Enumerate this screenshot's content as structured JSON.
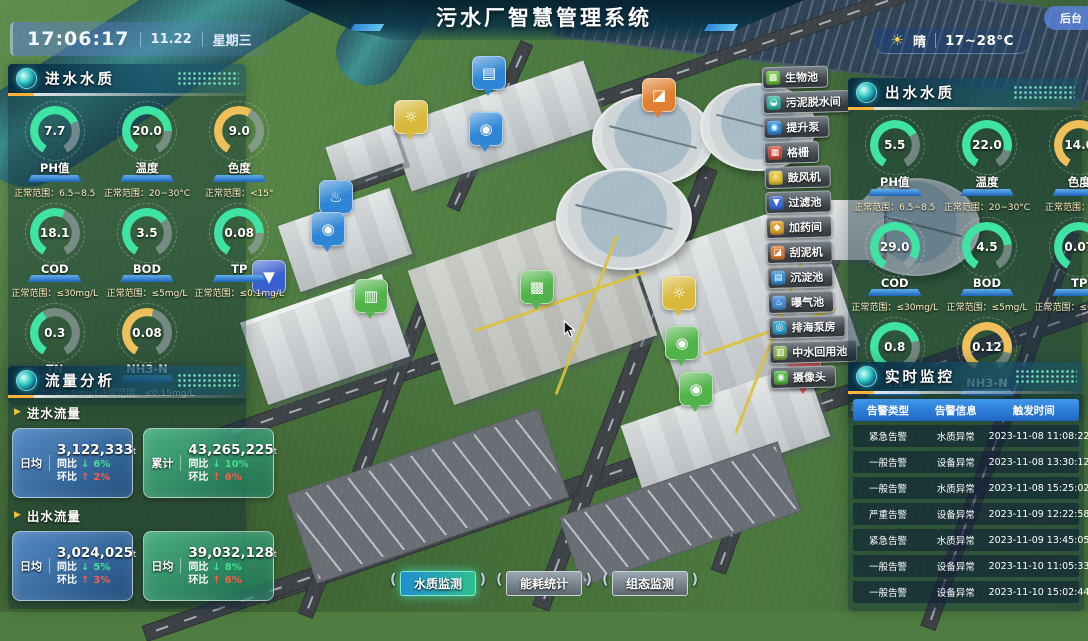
{
  "header": {
    "title": "污水厂智慧管理系统",
    "time": "17:06:17",
    "date": "11.22",
    "weekday": "星期三",
    "weather_icon": "☀",
    "weather": "晴",
    "temp_range": "17~28°C",
    "backend_label": "后台"
  },
  "labels": {
    "range_prefix": "正常范围：",
    "yoy": "同比",
    "mom": "环比",
    "down_arrow": "↓",
    "up_arrow": "↑"
  },
  "colors": {
    "gauge_green": "#3fe3a4",
    "gauge_yellow": "#eec05a",
    "label_bar_blue": "#2e7cd6",
    "trend_down_green": "#3fe38f",
    "trend_up_red": "#ff5a4a"
  },
  "inlet_quality": {
    "title": "进水水质",
    "gauges": [
      {
        "label": "PH值",
        "value": "7.7",
        "range": "6.5~8.5",
        "color": "#3fe3a4",
        "percent": 72
      },
      {
        "label": "温度",
        "value": "20.0",
        "range": "20~30°C",
        "color": "#3fe3a4",
        "percent": 80
      },
      {
        "label": "色度",
        "value": "9.0",
        "range": "<15°",
        "color": "#eec05a",
        "percent": 60
      },
      {
        "label": "COD",
        "value": "18.1",
        "range": "≤30mg/L",
        "color": "#3fe3a4",
        "percent": 58
      },
      {
        "label": "BOD",
        "value": "3.5",
        "range": "≤5mg/L",
        "color": "#3fe3a4",
        "percent": 68
      },
      {
        "label": "TP",
        "value": "0.08",
        "range": "≤0.1mg/L",
        "color": "#3fe3a4",
        "percent": 80
      },
      {
        "label": "TN",
        "value": "0.3",
        "range": "≤1.0mg/L",
        "color": "#3fe3a4",
        "percent": 40
      },
      {
        "label": "NH3-N",
        "value": "0.08",
        "range": "≤0.15mg/L",
        "color": "#eec05a",
        "percent": 55
      }
    ]
  },
  "outlet_quality": {
    "title": "出水水质",
    "gauges": [
      {
        "label": "PH值",
        "value": "5.5",
        "range": "6.5~8.5",
        "color": "#3fe3a4",
        "percent": 70
      },
      {
        "label": "温度",
        "value": "22.0",
        "range": "20~30°C",
        "color": "#3fe3a4",
        "percent": 85
      },
      {
        "label": "色度",
        "value": "14.0",
        "range": "<15°",
        "color": "#eec05a",
        "percent": 88
      },
      {
        "label": "COD",
        "value": "29.0",
        "range": "≤30mg/L",
        "color": "#3fe3a4",
        "percent": 90
      },
      {
        "label": "BOD",
        "value": "4.5",
        "range": "≤5mg/L",
        "color": "#3fe3a4",
        "percent": 78
      },
      {
        "label": "TP",
        "value": "0.07",
        "range": "≤0.1mg/L",
        "color": "#3fe3a4",
        "percent": 70
      },
      {
        "label": "TN",
        "value": "0.8",
        "range": "≤1.0mg/L",
        "color": "#3fe3a4",
        "percent": 75
      },
      {
        "label": "NH3-N",
        "value": "0.12",
        "range": "≤0.15mg/L",
        "color": "#eec05a",
        "percent": 85
      }
    ]
  },
  "flow": {
    "title": "流量分析",
    "inlet": {
      "subtitle": "进水流量",
      "cards": [
        {
          "tag": "日均",
          "value": "3,122,333",
          "unit": "t",
          "yoy": "6%",
          "mom": "2%",
          "style": "blue"
        },
        {
          "tag": "累计",
          "value": "43,265,225",
          "unit": "t",
          "yoy": "10%",
          "mom": "6%",
          "style": "green"
        }
      ]
    },
    "outlet": {
      "subtitle": "出水流量",
      "cards": [
        {
          "tag": "日均",
          "value": "3,024,025",
          "unit": "t",
          "yoy": "5%",
          "mom": "3%",
          "style": "blue"
        },
        {
          "tag": "日均",
          "value": "39,032,128",
          "unit": "t",
          "yoy": "8%",
          "mom": "6%",
          "style": "green"
        }
      ]
    }
  },
  "monitor": {
    "title": "实时监控",
    "columns": [
      "告警类型",
      "告警信息",
      "触发时间"
    ],
    "rows": [
      [
        "紧急告警",
        "水质异常",
        "2023-11-08 11:08:22"
      ],
      [
        "一般告警",
        "设备异常",
        "2023-11-08 13:30:12"
      ],
      [
        "一般告警",
        "水质异常",
        "2023-11-08 15:25:02"
      ],
      [
        "严重告警",
        "设备异常",
        "2023-11-09 12:22:58"
      ],
      [
        "紧急告警",
        "水质异常",
        "2023-11-09 13:45:05"
      ],
      [
        "一般告警",
        "设备异常",
        "2023-11-10 11:05:33"
      ],
      [
        "一般告警",
        "设备异常",
        "2023-11-10 15:02:44"
      ]
    ]
  },
  "facilities": [
    {
      "name": "facility-pill-biopool",
      "label": "生物池",
      "glyph": "▩",
      "color": "#6cbf3f"
    },
    {
      "name": "facility-pill-sludge-dewater",
      "label": "污泥脱水间",
      "glyph": "◒",
      "color": "#35b8a8"
    },
    {
      "name": "facility-pill-lift-pump",
      "label": "提升泵",
      "glyph": "◉",
      "color": "#2f8fe0"
    },
    {
      "name": "facility-pill-grille",
      "label": "格栅",
      "glyph": "▦",
      "color": "#d64c44"
    },
    {
      "name": "facility-pill-blower",
      "label": "鼓风机",
      "glyph": "☼",
      "color": "#e4c438"
    },
    {
      "name": "facility-pill-filter-pool",
      "label": "过滤池",
      "glyph": "▼",
      "color": "#3a6fd8"
    },
    {
      "name": "facility-pill-dosing-room",
      "label": "加药间",
      "glyph": "◆",
      "color": "#e0a432"
    },
    {
      "name": "facility-pill-mud-scraper",
      "label": "刮泥机",
      "glyph": "◪",
      "color": "#e07b35"
    },
    {
      "name": "facility-pill-sedimentation",
      "label": "沉淀池",
      "glyph": "▤",
      "color": "#3a8fd5"
    },
    {
      "name": "facility-pill-aeration",
      "label": "曝气池",
      "glyph": "♨",
      "color": "#4a90d8"
    },
    {
      "name": "facility-pill-sea-pump-house",
      "label": "排海泵房",
      "glyph": "◎",
      "color": "#2fa0d0"
    },
    {
      "name": "facility-pill-reuse-pool",
      "label": "中水回用池",
      "glyph": "▥",
      "color": "#8fb857"
    },
    {
      "name": "facility-pill-camera",
      "label": "摄像头",
      "glyph": "◉",
      "color": "#57b847"
    }
  ],
  "map_markers": [
    {
      "name": "map-marker-sedimentation-icon",
      "glyph": "▤",
      "color": "#2f86d6"
    },
    {
      "name": "map-marker-blower-icon",
      "glyph": "☼",
      "color": "#d8b93c"
    },
    {
      "name": "map-marker-lift-pump-icon",
      "glyph": "◉",
      "color": "#2f86d6"
    },
    {
      "name": "map-marker-mud-scraper-icon",
      "glyph": "◪",
      "color": "#e08030"
    },
    {
      "name": "map-marker-aeration-icon",
      "glyph": "♨",
      "color": "#2f86d6"
    },
    {
      "name": "map-marker-pump-icon",
      "glyph": "◉",
      "color": "#2f86d6"
    },
    {
      "name": "map-marker-filter-icon",
      "glyph": "▼",
      "color": "#3a5fd0"
    },
    {
      "name": "map-marker-reuse-pool-icon",
      "glyph": "▥",
      "color": "#52b34a"
    },
    {
      "name": "map-marker-biopool-icon",
      "glyph": "▩",
      "color": "#52b34a"
    },
    {
      "name": "map-marker-blower-2-icon",
      "glyph": "☼",
      "color": "#d8b93c"
    },
    {
      "name": "map-marker-camera-icon",
      "glyph": "◉",
      "color": "#52b34a"
    },
    {
      "name": "map-marker-grille-icon",
      "glyph": "▦",
      "color": "#d64545"
    },
    {
      "name": "map-marker-camera-2-icon",
      "glyph": "◉",
      "color": "#52b34a"
    }
  ],
  "footer_tabs": [
    {
      "label": "水质监测",
      "active": "true"
    },
    {
      "label": "能耗统计",
      "active": "false"
    },
    {
      "label": "组态监测",
      "active": "false"
    }
  ]
}
